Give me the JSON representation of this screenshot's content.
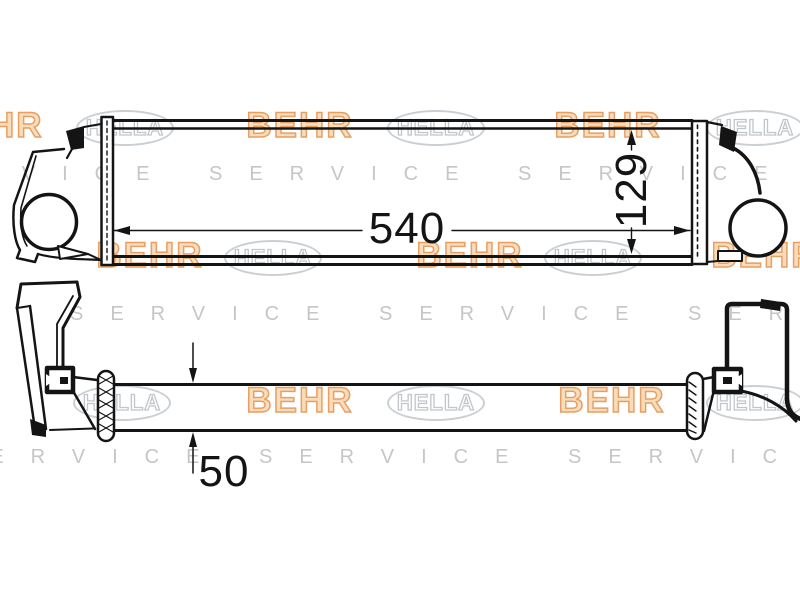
{
  "canvas": {
    "width": 800,
    "height": 600,
    "background": "#ffffff"
  },
  "drawing": {
    "type": "technical-part-drawing",
    "subject": "intercooler-two-view",
    "line_color": "#141414",
    "views": {
      "front_view": {
        "dimension_labels": {
          "length": "540",
          "height": "129"
        }
      },
      "top_view": {
        "dimension_labels": {
          "depth": "50"
        }
      }
    }
  },
  "watermarks": {
    "behr": "BEHR",
    "hella": "HELLA",
    "service": "SERVICE SERVICE SERVICE SERVICE",
    "colors": {
      "behr_fill": "#f8d5ab",
      "behr_stroke": "#e0893f",
      "hella": "#949ea8",
      "service": "#c6c6c6"
    }
  }
}
